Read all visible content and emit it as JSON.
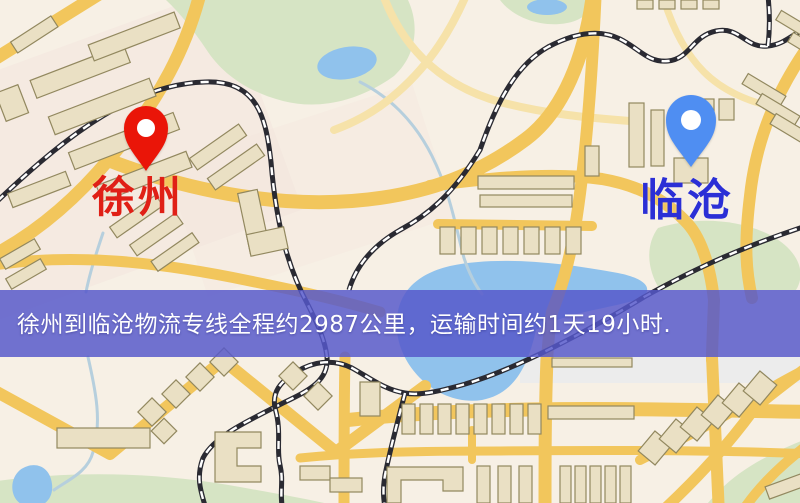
{
  "banner": {
    "text": "徐州到临沧物流专线全程约2987公里，运输时间约1天19小时."
  },
  "markers": {
    "origin": {
      "label": "徐州",
      "pin": "red-map-pin",
      "pin_color": "#ea1508",
      "label_color": "#e02016"
    },
    "destination": {
      "label": "临沧",
      "pin": "blue-map-pin",
      "pin_color": "#4f8ef2",
      "label_color": "#2b2fd6"
    }
  },
  "theme": {
    "map-bg": "#f7f0e5",
    "tint": "#f4e4dd",
    "road": "#f2c65c",
    "road-light": "#f6e2a9",
    "building": "#eae0c4",
    "building-stroke": "#92885f",
    "park": "#d6e4c4",
    "water": "#90c2ec",
    "stream": "#b6cfdd",
    "railway": "#2a2a32",
    "banner-bg": "rgba(86,88,202,0.84)",
    "banner-text": "#ffffff",
    "origin-pin": "#ea1508",
    "origin-label": "#e02016",
    "destination-pin": "#4f8ef2",
    "destination-label": "#2b2fd6"
  }
}
